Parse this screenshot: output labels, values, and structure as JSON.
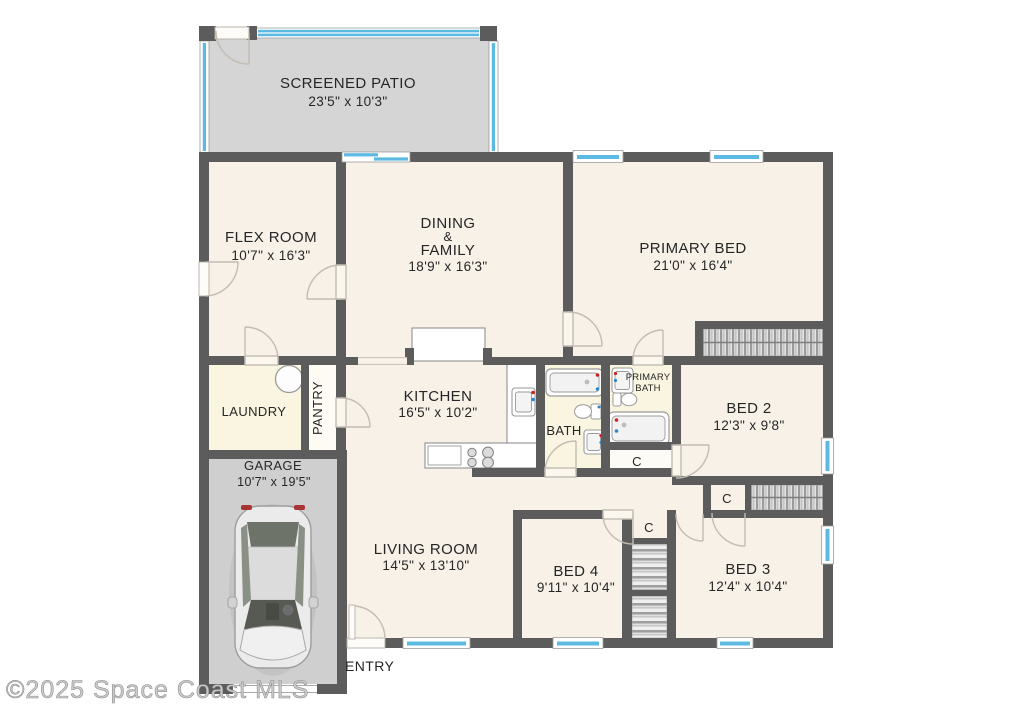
{
  "watermark": "©2025 Space Coast MLS",
  "rooms": {
    "patio": {
      "name": "SCREENED PATIO",
      "dims": "23'5\" x 10'3\""
    },
    "flex": {
      "name": "FLEX ROOM",
      "dims": "10'7\" x 16'3\""
    },
    "dining": {
      "name_line1": "DINING",
      "name_line2": "&",
      "name_line3": "FAMILY",
      "dims": "18'9\" x 16'3\""
    },
    "primary_bed": {
      "name": "PRIMARY BED",
      "dims": "21'0\" x 16'4\""
    },
    "kitchen": {
      "name": "KITCHEN",
      "dims": "16'5\" x 10'2\""
    },
    "bath": {
      "name": "BATH"
    },
    "primary_bath": {
      "name_line1": "PRIMARY",
      "name_line2": "BATH"
    },
    "bed2": {
      "name": "BED 2",
      "dims": "12'3\" x 9'8\""
    },
    "laundry": {
      "name": "LAUNDRY"
    },
    "pantry": {
      "name": "PANTRY"
    },
    "garage": {
      "name": "GARAGE",
      "dims": "10'7\" x 19'5\""
    },
    "living": {
      "name": "LIVING ROOM",
      "dims": "14'5\" x 13'10\""
    },
    "bed4": {
      "name": "BED 4",
      "dims": "9'11\" x 10'4\""
    },
    "bed3": {
      "name": "BED 3",
      "dims": "12'4\" x 10'4\""
    },
    "entry": {
      "name": "ENTRY"
    },
    "closet": {
      "label": "C"
    }
  },
  "colors": {
    "wall": "#5c5c5c",
    "floor": "#f7f1e8",
    "wet_floor": "#faf5e0",
    "patio_floor": "#d5d5d5",
    "garage_floor": "#cfcfcf",
    "window_blue": "#5cb9e2",
    "text": "#262626",
    "door_arc": "#c2bcb2"
  }
}
